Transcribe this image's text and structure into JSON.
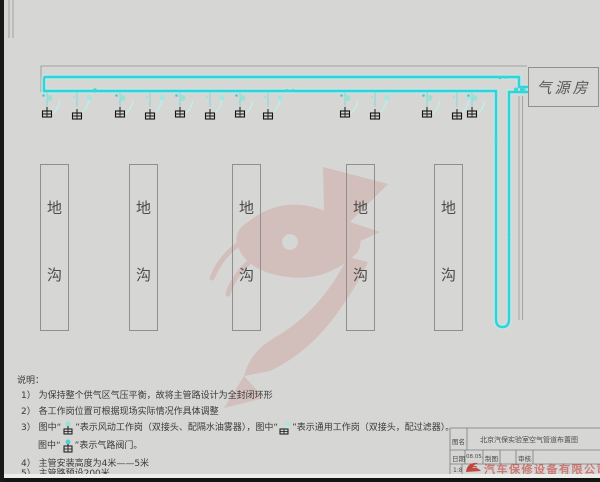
{
  "diagram": {
    "air_source_room_label": "气源房",
    "trench_char_top": "地",
    "trench_char_bottom": "沟",
    "pipe_color": "#35d8dc"
  },
  "notes": {
    "heading": "说明：",
    "line1": "1） 为保持整个供气区气压平衡，故将主管路设计为全封闭环形",
    "line2": "2） 各工作岗位置可根据现场实际情况作具体调整",
    "line3_a": "3） 图中“",
    "line3_b": "”表示风动工作岗（双接头、配隔水油雾器），图中“",
    "line3_c": "”表示通用工作岗（双接头，配过滤器）。",
    "line3d_a": "图中“",
    "line3d_b": "”表示气路阀门。",
    "line4": "4） 主管安装高度为4米——5米",
    "line5": "5） 主管路预设200米。"
  },
  "title_block": {
    "name_label": "图名:",
    "drawing_title": "北京汽保实验室空气管道布置图",
    "date_label": "日期:",
    "date_value": "08.05.22",
    "draft_label": "制图:",
    "check_label": "审核:",
    "scale_value": "1:8",
    "company_text": "汽车保修设备有限公司"
  }
}
